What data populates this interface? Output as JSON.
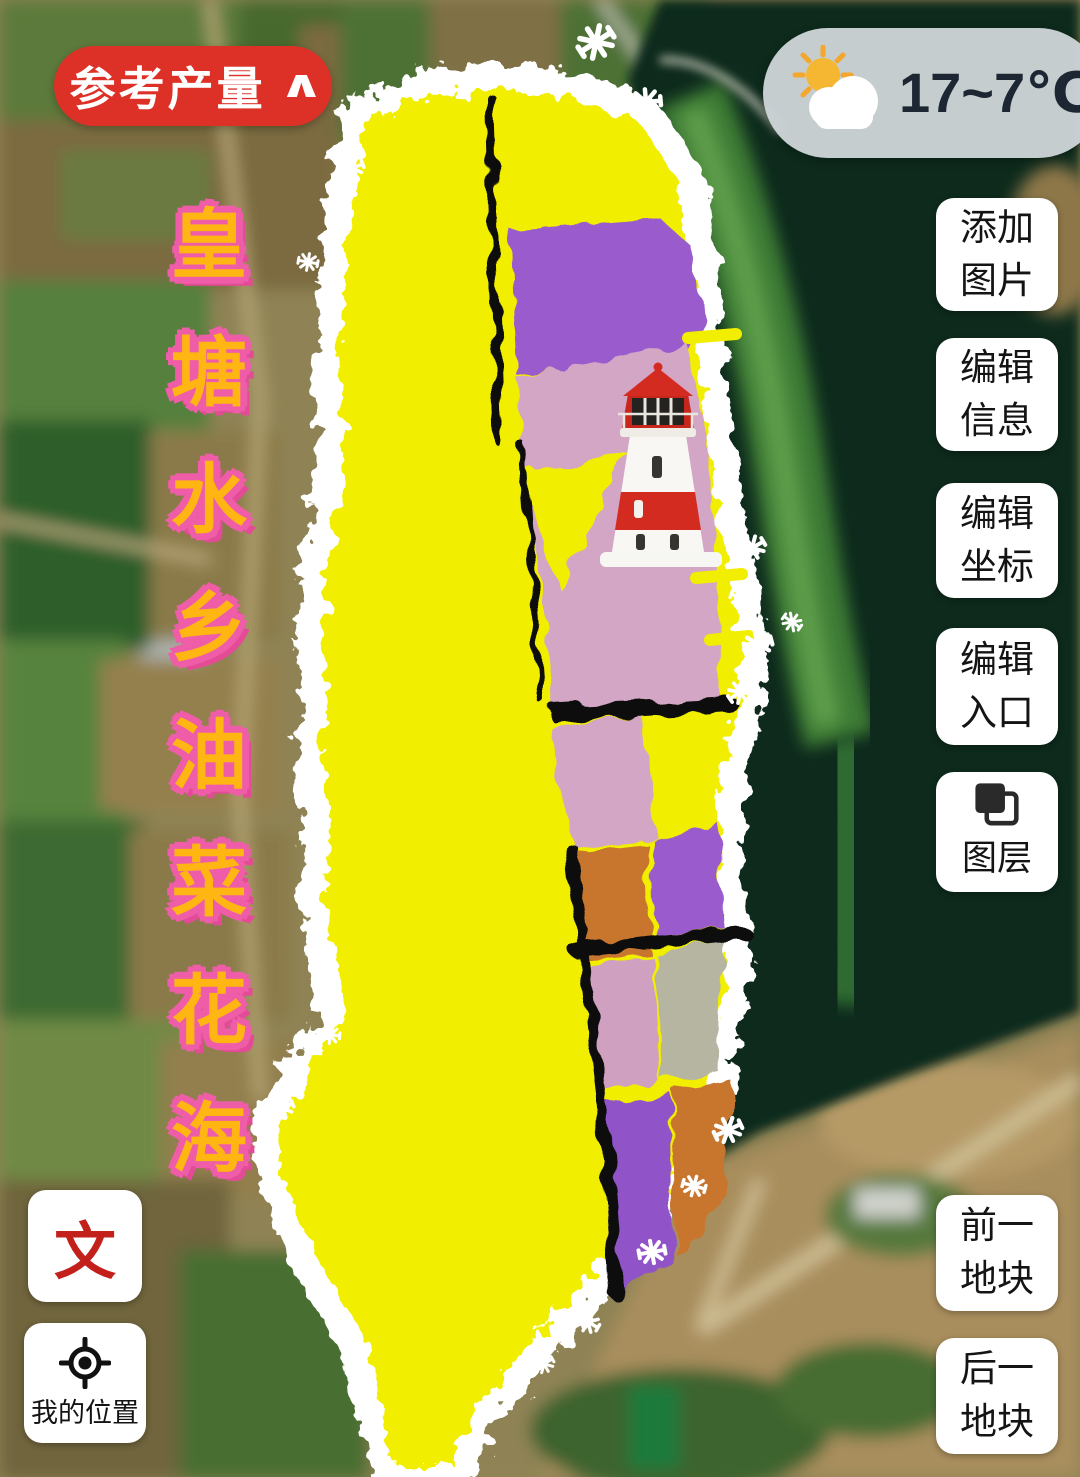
{
  "yield_button": {
    "label": "参考产量",
    "chevron": "∧"
  },
  "weather": {
    "temperature": "17~7℃",
    "icon": "sun-behind-cloud-icon"
  },
  "map": {
    "title_vertical": "皇塘水乡油菜花海",
    "landmark": "lighthouse",
    "colors": {
      "rapeseed_yellow": "#f2ee00",
      "field_purple": "#9a5ccd",
      "field_pink": "#d2a6c4",
      "field_orange": "#c8742e",
      "field_gray": "#b5b5a2",
      "water_dark_green": "#0d2b1a",
      "border_white": "#ffffff",
      "lighthouse_red": "#d42b20"
    }
  },
  "right_toolbar": {
    "items": [
      {
        "label": "添加图片"
      },
      {
        "label": "编辑信息"
      },
      {
        "label": "编辑坐标"
      },
      {
        "label": "编辑入口"
      },
      {
        "label": "图层",
        "icon": "layers-icon"
      }
    ]
  },
  "bottom_left": {
    "text_button": "文",
    "location_button": "我的位置"
  },
  "bottom_right": {
    "prev_button": "前一地块",
    "next_button": "后一地块"
  }
}
